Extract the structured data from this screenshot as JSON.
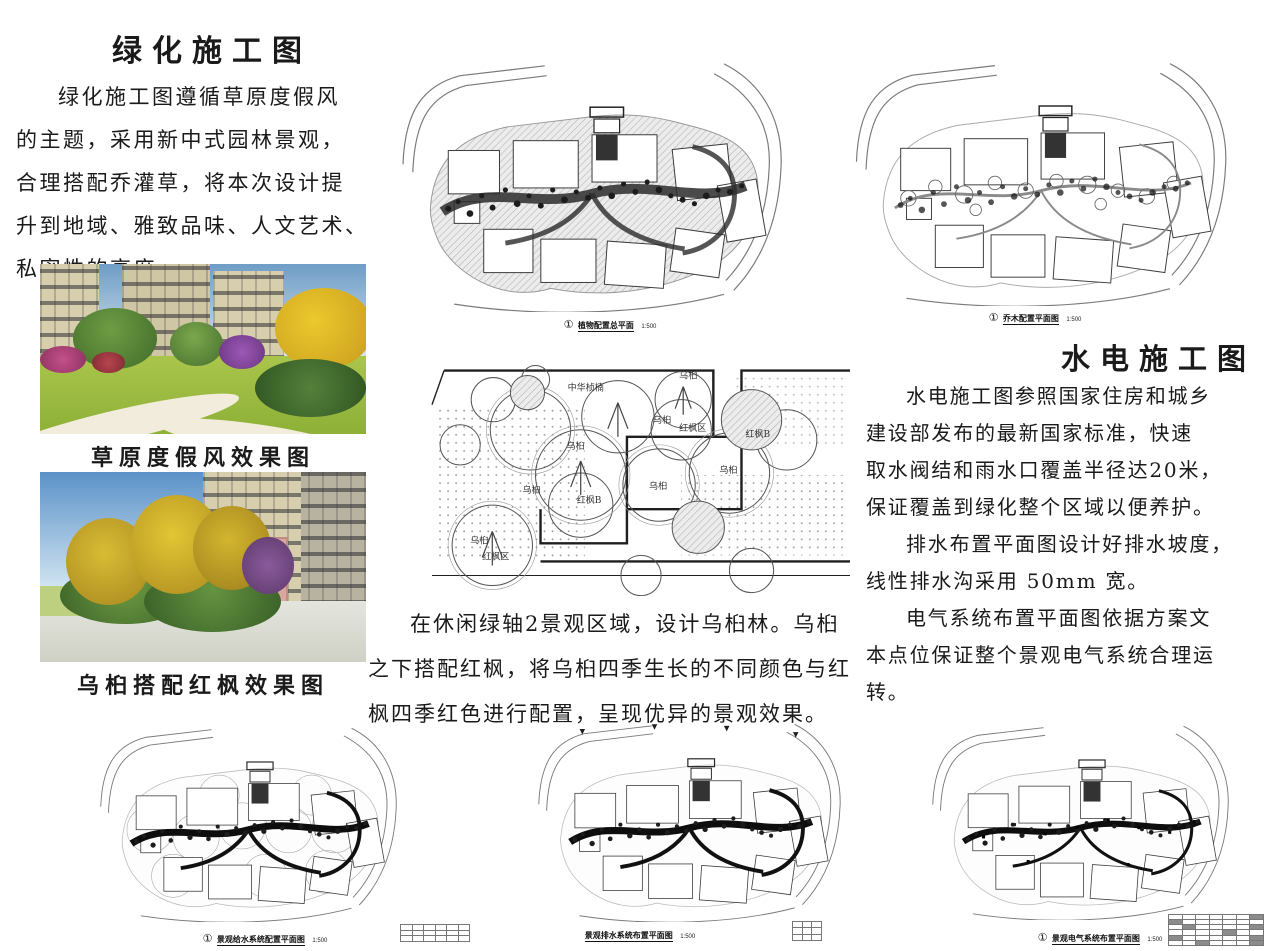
{
  "accent_colors": {
    "text": "#1a1a1a",
    "plan_line": "#2a2a2a",
    "hatch": "#b5b5b5"
  },
  "left": {
    "title": "绿化施工图",
    "paragraph_lines": [
      "绿化施工图遵循草原度假风",
      "的主题，采用新中式园林景观，",
      "合理搭配乔灌草，将本次设计提",
      "升到地域、雅致品味、人文艺术、",
      "私密性的高度。"
    ],
    "photo1_caption": "草原度假风效果图",
    "photo2_caption": "乌桕搭配红枫效果图"
  },
  "center": {
    "paragraph_lines": [
      "在休闲绿轴2景观区域，设计乌桕林。乌桕",
      "之下搭配红枫，将乌桕四季生长的不同颜色与红",
      "枫四季红色进行配置，呈现优异的景观效果。"
    ]
  },
  "right": {
    "title": "水电施工图",
    "lines": [
      "水电施工图参照国家住房和城乡",
      "建设部发布的最新国家标准，快速",
      "取水阀结和雨水口覆盖半径达20米，",
      "保证覆盖到绿化整个区域以便养护。",
      "排水布置平面图设计好排水坡度，",
      "线性排水沟采用 50mm 宽。",
      "电气系统布置平面图依据方案文",
      "本点位保证整个景观电气系统合理运",
      "转。"
    ]
  },
  "plans": {
    "planting_total": {
      "num": "①",
      "label": "植物配置总平面",
      "scale": "1:500"
    },
    "tree_layout": {
      "num": "①",
      "label": "乔木配置平面图",
      "scale": "1:500"
    },
    "water_supply": {
      "num": "①",
      "label": "景观给水系统配置平面图",
      "scale": "1:500"
    },
    "drainage": {
      "label": "景观排水系统布置平面图",
      "scale": "1:500"
    },
    "electrical": {
      "num": "①",
      "label": "景观电气系统布置平面图",
      "scale": "1:500"
    }
  },
  "detail_plan": {
    "labels": [
      "中华桢楠",
      "乌桕",
      "乌桕",
      "红枫区",
      "红枫B",
      "乌桕",
      "乌桕",
      "红枫B",
      "乌桕",
      "乌桕",
      "乌桕",
      "红枫区"
    ]
  }
}
